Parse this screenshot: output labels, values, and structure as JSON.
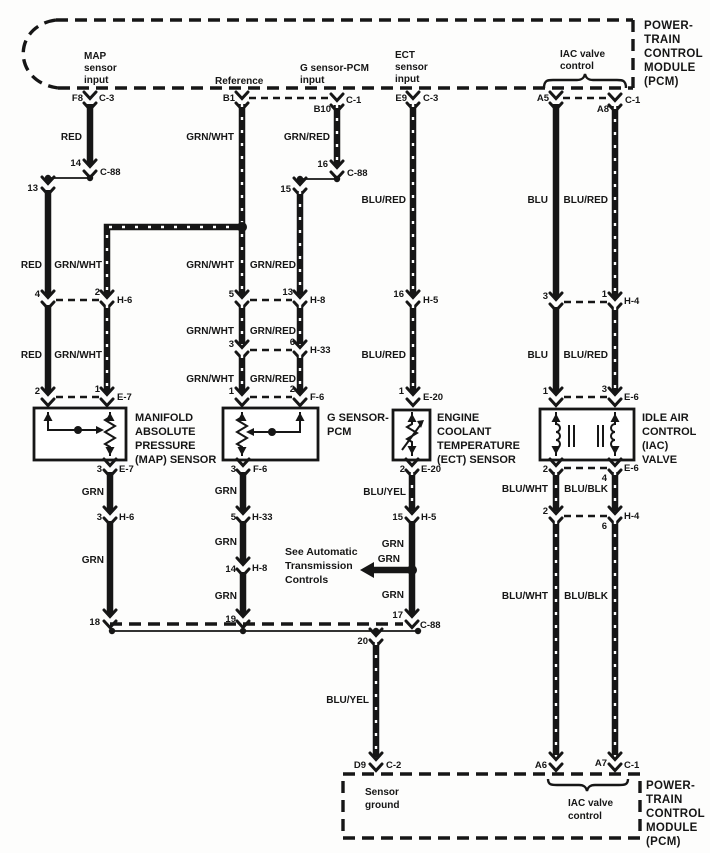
{
  "module": {
    "lines": [
      "POWER-",
      "TRAIN",
      "CONTROL",
      "MODULE",
      "(PCM)"
    ]
  },
  "top_box": {
    "map_input": [
      "MAP",
      "sensor",
      "input"
    ],
    "reference": "Reference",
    "g_input": [
      "G sensor-PCM",
      "input"
    ],
    "ect_input": [
      "ECT",
      "sensor",
      "input"
    ],
    "iac_control": [
      "IAC valve",
      "control"
    ]
  },
  "bottom_box": {
    "sensor_ground": [
      "Sensor",
      "ground"
    ],
    "iac_control": [
      "IAC valve",
      "control"
    ]
  },
  "components": {
    "map": [
      "MANIFOLD",
      "ABSOLUTE",
      "PRESSURE",
      "(MAP) SENSOR"
    ],
    "g": [
      "G SENSOR-",
      "PCM"
    ],
    "ect": [
      "ENGINE",
      "COOLANT",
      "TEMPERATURE",
      "(ECT) SENSOR"
    ],
    "iac": [
      "IDLE AIR",
      "CONTROL",
      "(IAC)",
      "VALVE"
    ]
  },
  "note": [
    "See Automatic",
    "Transmission",
    "Controls"
  ],
  "colors": {
    "red": "RED",
    "grn_wht": "GRN/WHT",
    "grn_red": "GRN/RED",
    "blu_red": "BLU/RED",
    "blu": "BLU",
    "grn": "GRN",
    "blu_yel": "BLU/YEL",
    "blu_wht": "BLU/WHT",
    "blu_blk": "BLU/BLK"
  },
  "connectors": {
    "c3": "C-3",
    "c88": "C-88",
    "c1": "C-1",
    "c2": "C-2",
    "e7": "E-7",
    "f6": "F-6",
    "e20": "E-20",
    "e6": "E-6",
    "h6": "H-6",
    "h8": "H-8",
    "h33": "H-33",
    "h5": "H-5",
    "h4": "H-4"
  },
  "terminals": {
    "f8": "F8",
    "b1": "B1",
    "b10": "B10",
    "e9": "E9",
    "a5": "A5",
    "a8": "A8",
    "a6": "A6",
    "a7": "A7",
    "d9": "D9",
    "n1": "1",
    "n2": "2",
    "n3": "3",
    "n4": "4",
    "n5": "5",
    "n6": "6",
    "n13": "13",
    "n14": "14",
    "n15": "15",
    "n16": "16",
    "n17": "17",
    "n18": "18",
    "n19": "19",
    "n20": "20"
  }
}
